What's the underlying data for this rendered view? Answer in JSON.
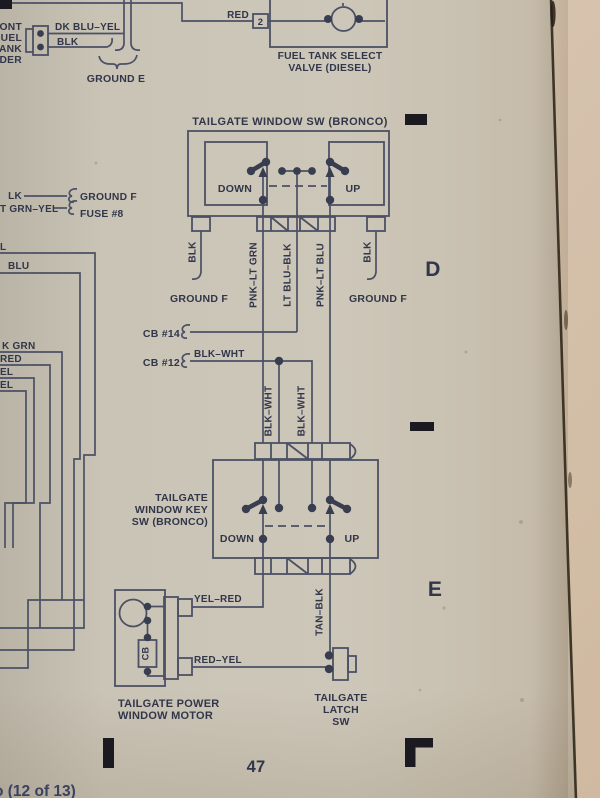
{
  "page": {
    "number": "47",
    "footer_partial": "o (12 of 13)",
    "grid_letter_d": "D",
    "grid_letter_e": "E"
  },
  "colors": {
    "paper": "#cbc5b7",
    "paper_behind": "#d5c2ac",
    "ink_text": "#31364a",
    "ink_line": "#4b5064",
    "registration_mark": "#1b1a20",
    "page_edge_seam": "#2f2819",
    "footer_ink": "#3a4161"
  },
  "front_sender": {
    "partial_line1": "ONT",
    "partial_line2": "UEL",
    "partial_line3": "ANK",
    "partial_line4": "DER",
    "wire_top": "DK BLU–YEL",
    "wire_bottom": "BLK",
    "ground_label": "GROUND E"
  },
  "fuel_valve": {
    "wire": "RED",
    "pin": "2",
    "title_line1": "FUEL TANK SELECT",
    "title_line2": "VALVE (DIESEL)"
  },
  "left_branch": {
    "wire_blk_partial": "LK",
    "ground_label": "GROUND F",
    "wire_grn_yel_partial": "T GRN–YEL",
    "fuse_label": "FUSE #8",
    "nested_label_1": "L",
    "nested_label_2": "BLU",
    "nested_label_3": "K GRN",
    "nested_label_4": "RED",
    "nested_label_5": "EL",
    "nested_label_6": "EL"
  },
  "window_switch": {
    "title": "TAILGATE WINDOW SW (BRONCO)",
    "down_label": "DOWN",
    "up_label": "UP",
    "wire_blk_left": "BLK",
    "wire_blk_right": "BLK",
    "ground_left": "GROUND F",
    "ground_right": "GROUND F",
    "wire_1": "PNK–LT GRN",
    "wire_2": "LT BLU–BLK",
    "wire_3": "PNK–LT BLU"
  },
  "breakers": {
    "cb14_label": "CB #14",
    "cb12_label": "CB #12",
    "cb12_wire": "BLK–WHT",
    "riser_wire_1": "BLK–WHT",
    "riser_wire_2": "BLK–WHT"
  },
  "key_switch": {
    "title_line1": "TAILGATE",
    "title_line2": "WINDOW KEY",
    "title_line3": "SW (BRONCO)",
    "down_label": "DOWN",
    "up_label": "UP"
  },
  "motor": {
    "title_line1": "TAILGATE POWER",
    "title_line2": "WINDOW MOTOR",
    "breaker_label": "CB",
    "wire_up": "YEL–RED",
    "wire_down": "RED–YEL"
  },
  "latch_switch": {
    "title_line1": "TAILGATE",
    "title_line2": "LATCH",
    "title_line3": "SW",
    "wire": "TAN–BLK"
  }
}
